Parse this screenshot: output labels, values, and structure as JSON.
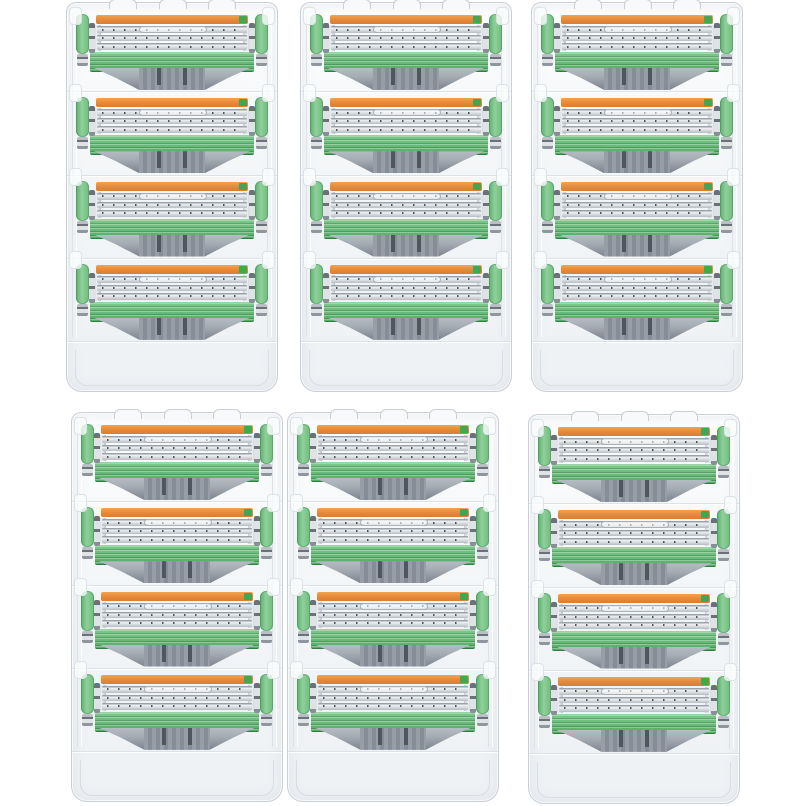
{
  "scene": {
    "type": "product-photo",
    "alt": "Six clear plastic refill trays arranged in a 3 by 2 grid on a white background, each tray holding four razor blade cartridges; every cartridge has an orange lubricating strip on top with a small green end cap, three silver dotted blade rows, a ridged green guard bar, a gray ribbed mounting back, and green side tabs",
    "background_color": "#ffffff"
  },
  "layout": {
    "grid": {
      "rows": 2,
      "cols": 3
    },
    "pack_size": {
      "width": 212,
      "height": 390
    },
    "cartridges_per_pack": 4,
    "blade_rows_per_cartridge": 3,
    "packs": [
      {
        "id": "razor-pack-top-left",
        "x": 66,
        "y": 2
      },
      {
        "id": "razor-pack-top-center",
        "x": 300,
        "y": 2
      },
      {
        "id": "razor-pack-top-right",
        "x": 531,
        "y": 2
      },
      {
        "id": "razor-pack-bottom-left",
        "x": 71,
        "y": 412
      },
      {
        "id": "razor-pack-bottom-center",
        "x": 287,
        "y": 412
      },
      {
        "id": "razor-pack-bottom-right",
        "x": 528,
        "y": 414
      }
    ]
  },
  "colors": {
    "tray_border": "#c9cfd6",
    "tray_inner_line": "#dde2e7",
    "lubricating_strip_orange": "#e5893b",
    "strip_end_green": "#43a653",
    "blade_silver": "#d9dde0",
    "blade_edge": "#9aa1a8",
    "blade_dots": "#3e464d",
    "guard_bar_green": "#54ac66",
    "guard_bar_green_light": "#7cc98b",
    "side_tab_green": "#8fd09a",
    "side_tab_border": "#5fae70",
    "pin_band": "#6a7178",
    "back_gray": "#a4abb3",
    "back_center_gray": "#979ea7",
    "back_rib_gray": "#868d96",
    "back_slot_dark": "#4f565e"
  }
}
